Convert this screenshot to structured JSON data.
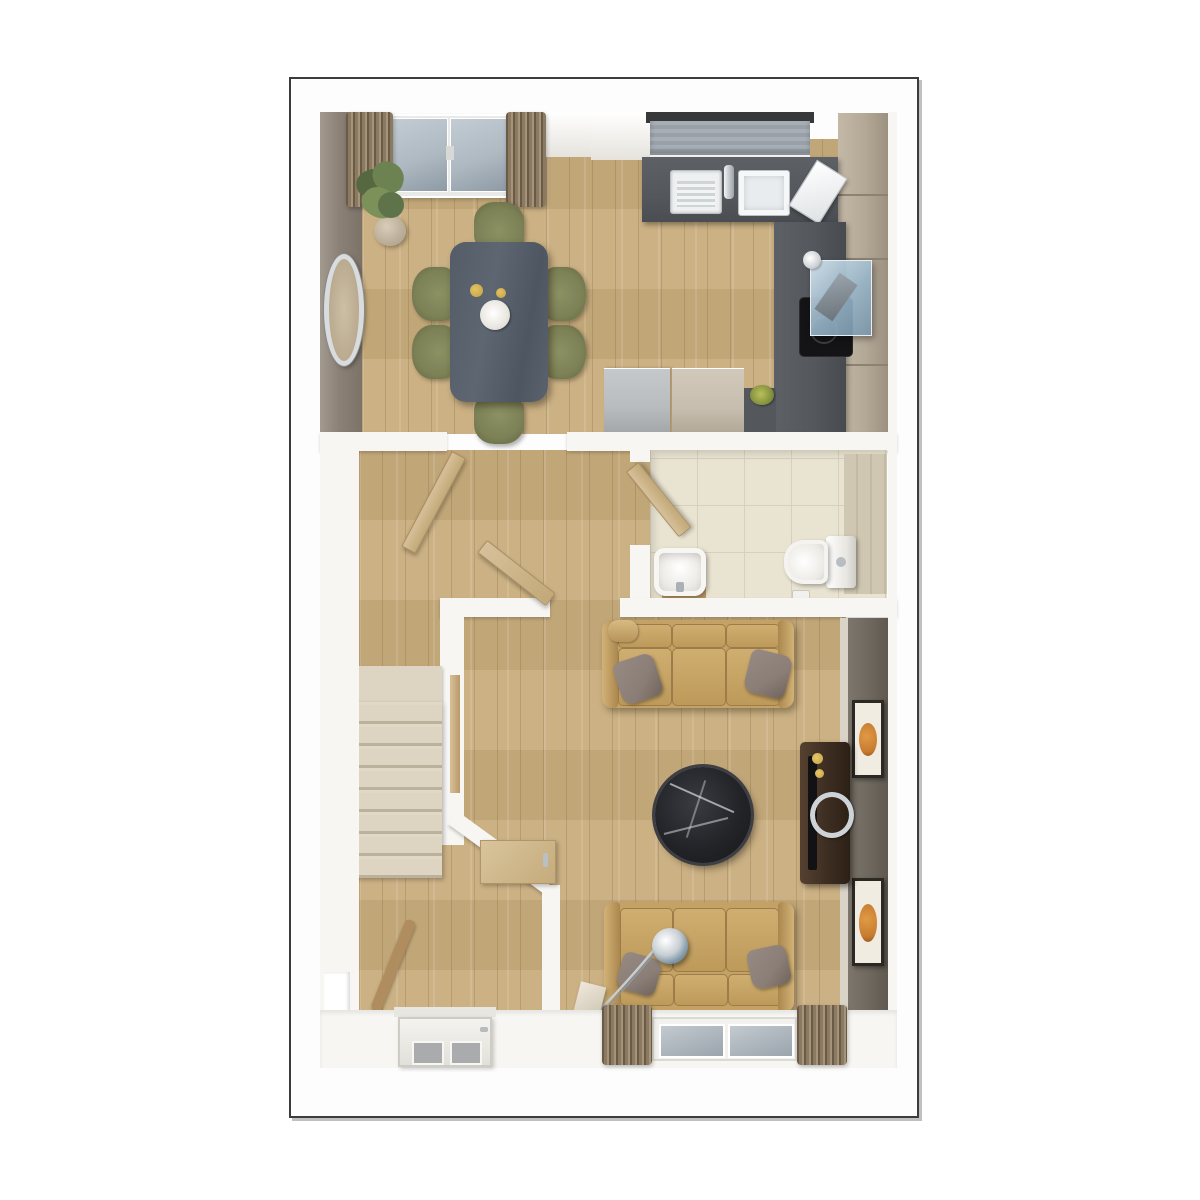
{
  "meta": {
    "title": "3D ground-floor plan render, top-down dollhouse view",
    "visible_text": "none",
    "frame": {
      "border_color": "#3c3c3c",
      "background": "#ffffff"
    }
  },
  "palette": {
    "floor_wood": "#c9ad7d",
    "wall_white": "#f7f6f3",
    "wall_taupe": "#8b8177",
    "wall_dark": "#6e675e",
    "counter_dark": "#54585d",
    "cabinet_beige": "#b3a796",
    "sofa_tan": "#c4a164",
    "chair_olive": "#7c8156",
    "table_slate": "#5d6671",
    "stairs_cream": "#ddd5c2",
    "tile_cream": "#e9e3d1",
    "curtain_brown": "#8b7a62",
    "glass_blue": "#aeb9c2",
    "marble_black": "#232428",
    "media_wood": "#3f2f23",
    "art_orange": "#c67a2f",
    "chrome": "#cdd2d6",
    "gold": "#c3a23f",
    "blind_gray": "#99a0a8",
    "appliance_gray": "#b9bcbe"
  },
  "rooms": [
    {
      "id": "dining-area",
      "position": "top-left",
      "contents": [
        "french-doors",
        "curtains",
        "potted-plant",
        "oval-wall-mirror",
        "dining-table",
        "six-olive-chairs",
        "plate-and-gold-cups"
      ]
    },
    {
      "id": "kitchen",
      "position": "top-right",
      "contents": [
        "window-with-gray-blind",
        "dark-l-shaped-worktop",
        "stainless-sink-and-drainer",
        "tap",
        "draining-board",
        "glass-extractor-hood",
        "black-hob",
        "beige-tall-cabinets",
        "gray-appliance",
        "beige-base-unit",
        "green-bowl"
      ]
    },
    {
      "id": "hallway",
      "position": "left-middle",
      "contents": [
        "staircase-with-landing",
        "wood-banister",
        "three-open-doors",
        "under-stairs-cupboard-door",
        "front-door-with-glazing"
      ]
    },
    {
      "id": "wc",
      "position": "middle-right",
      "contents": [
        "cream-tiled-floor",
        "basin-on-wood-stand",
        "toilet-with-cistern",
        "tiled-feature-wall"
      ]
    },
    {
      "id": "living-room",
      "position": "bottom-right",
      "contents": [
        "two-tan-sofas",
        "gray-throw-pillows",
        "round-black-marble-coffee-table",
        "dark-wood-media-unit",
        "tv",
        "chrome-ring-decor",
        "two-orange-wall-artworks",
        "arc-floor-lamp",
        "window-with-curtains"
      ]
    }
  ]
}
